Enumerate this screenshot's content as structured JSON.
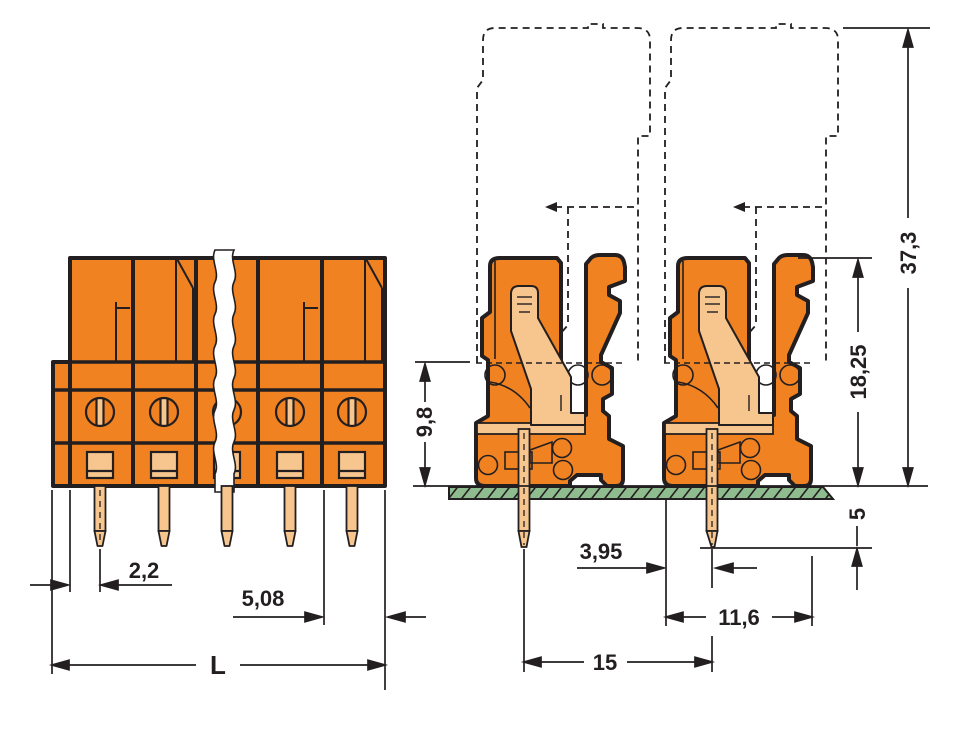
{
  "drawing": {
    "type": "technical-dimension-drawing",
    "views": {
      "front_view": "multi-pole female header with break line",
      "side_view": "two poles soldered on PCB with dashed mating plug outline"
    },
    "dimensions": {
      "pin_to_housing_edge": "2,2",
      "pole_pitch": "5,08",
      "overall_length": "L",
      "housing_height_front": "9,8",
      "height_above_pcb": "18,25",
      "total_height_with_mating_plug": "37,3",
      "pin_length_below_pcb": "5",
      "pin_offset_from_edge": "3,95",
      "housing_depth": "11,6",
      "row_spacing": "15"
    },
    "colors": {
      "housing": "#F08222",
      "contacts": "#F7C68F",
      "pcb": "#8FBC8F",
      "lines": "#231F20"
    }
  }
}
